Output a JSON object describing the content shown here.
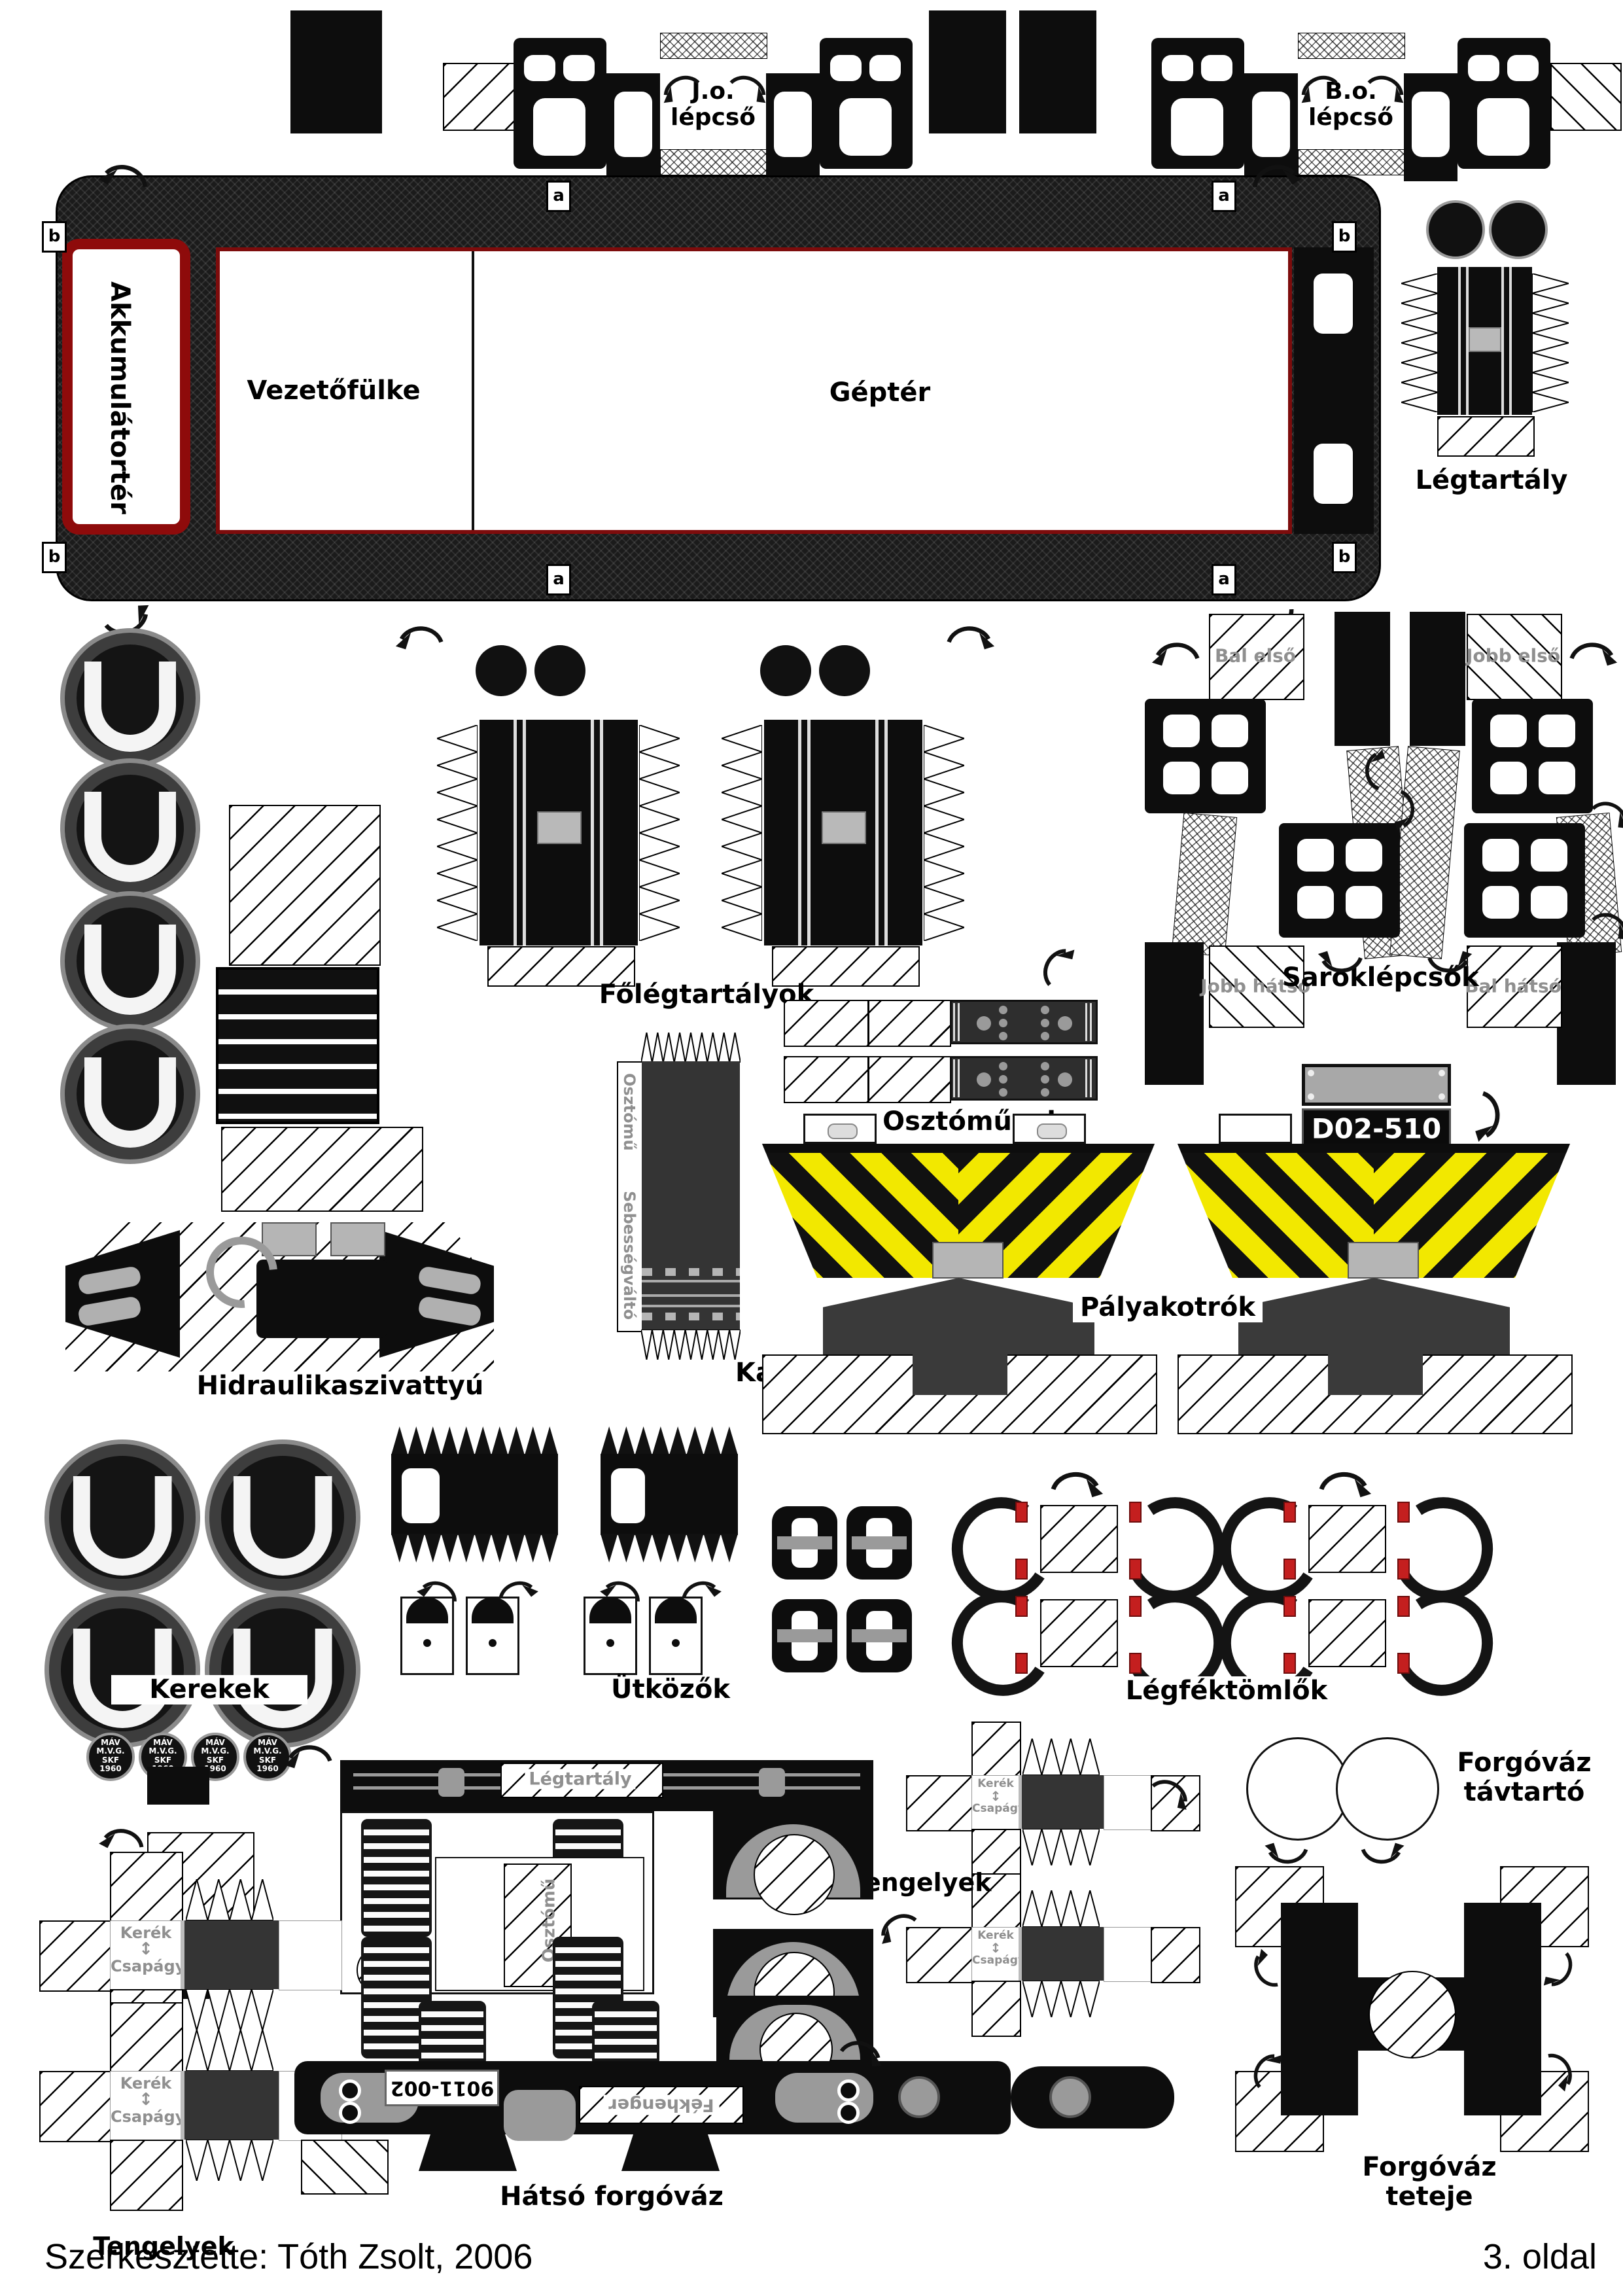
{
  "page": {
    "footer_left": "Szerkesztette: Tóth Zsolt, 2006",
    "footer_right": "3. oldal"
  },
  "colors": {
    "dark_red_frame": "#8e0b0b",
    "chevron_yellow": "#f2e800",
    "roof_dark": "#1b1b1b",
    "part_dark_gray": "#343434",
    "note_gray": "#8f8f8f",
    "clamp_red": "#c41f1f"
  },
  "top_steps": {
    "left_label": "J.o.\nlépcső",
    "right_label": "B.o.\nlépcső"
  },
  "body": {
    "battery_label": "Akkumulátortér",
    "cab_label": "Vezetőfülke",
    "engine_label": "Géptér",
    "tab_a": "a",
    "tab_b": "b"
  },
  "air_tank": {
    "label": "Légtartály"
  },
  "main_air_tanks": {
    "label": "Főlégtartályok"
  },
  "corner_steps": {
    "label": "Saroklépcsők",
    "tab_front_left": "Bal első",
    "tab_front_right": "Jobb első",
    "tab_rear_right": "Jobb hátsó",
    "tab_rear_left": "Bal hátsó"
  },
  "distributors": {
    "label": "Osztóművek"
  },
  "number_plate": {
    "text": "D02-510"
  },
  "plows": {
    "label": "Pályakotrók"
  },
  "hydraulic_pump": {
    "label": "Hidraulikaszivattyú"
  },
  "cardan_shaft": {
    "label": "Kardántengely",
    "top_note": "Osztómű",
    "bottom_note": "Sebességváltó"
  },
  "wheels": {
    "label": "Kerekek",
    "badge_text": "MÁV\nM.V.G.\nSKF\n1960"
  },
  "buffers": {
    "label": "Ütközők"
  },
  "brake_hoses": {
    "label": "Légféktömlők"
  },
  "axles": {
    "label": "Tengelyek",
    "wheel_note": "Kerék",
    "bearing_note": "Csapágy",
    "updown_arrow": "↕"
  },
  "bogie_spacer": {
    "label": "Forgóváz\ntávtartó"
  },
  "front_bogie": {
    "tank_note": "Légtartály",
    "distributor_note": "Osztómű"
  },
  "rear_bogie": {
    "label": "Hátsó forgóváz",
    "plate_text": "9011-002",
    "brake_note": "Fékhenger"
  },
  "bogie_top": {
    "label": "Forgóváz teteje"
  }
}
